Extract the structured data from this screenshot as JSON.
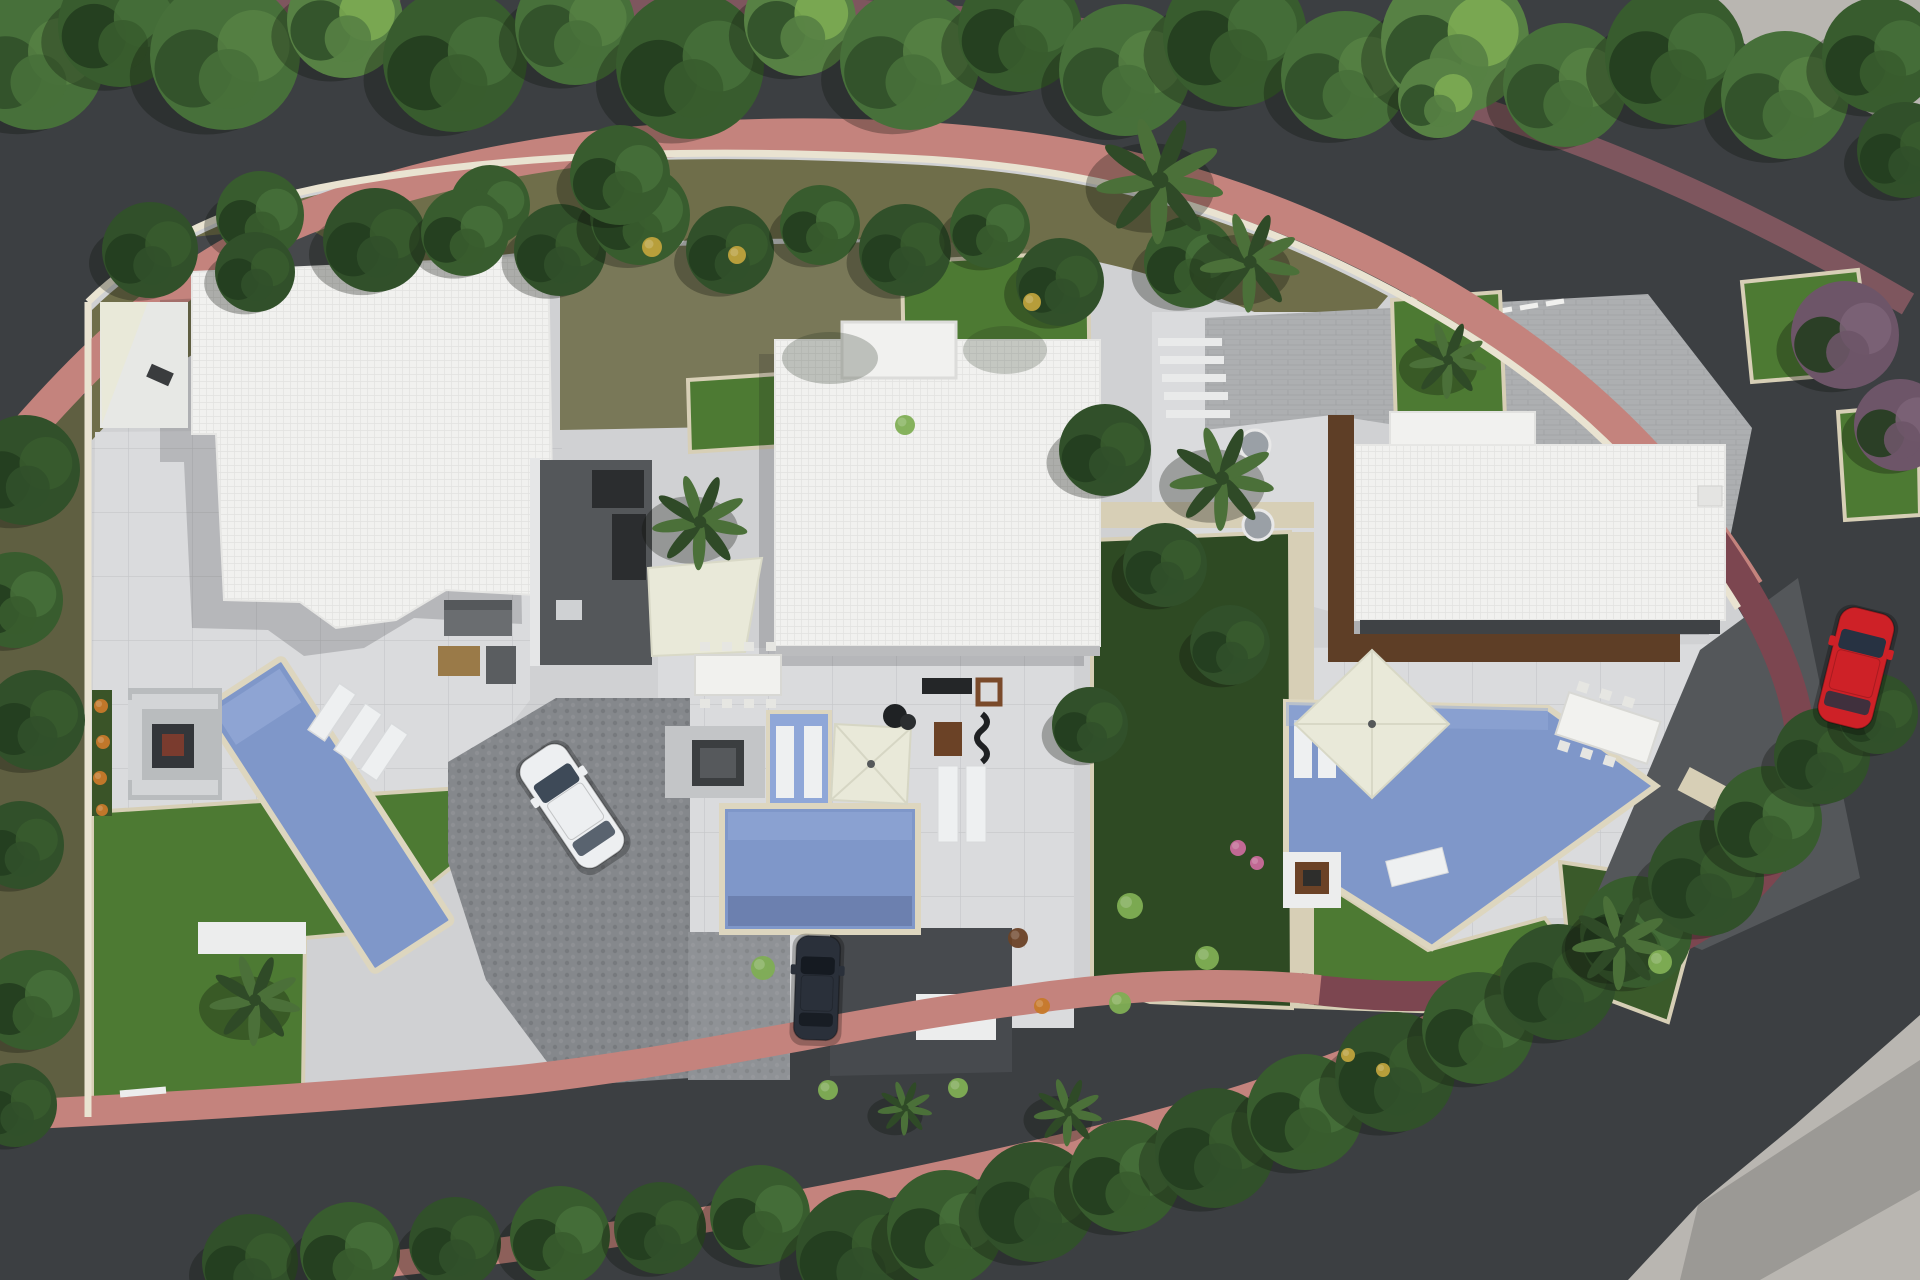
{
  "meta": {
    "description": "Aerial 3D architectural site plan render: three modern flat-roof villas with pools and gardens along a curving tree-lined road",
    "canvas": {
      "width": 1920,
      "height": 1280
    },
    "villa_count": 3,
    "pool_count": 4,
    "car_count": 3
  },
  "palette": {
    "road": "#3c3f42",
    "sidewalkPink": "#c4837d",
    "sidewalkMauve": "#7e565e",
    "sidewalkMaroon": "#7c4650",
    "wall": "#e9e3d1",
    "stone": "#d7cfb6",
    "concrete": "#b9b6b1",
    "olive": "#6f6e4a",
    "oliveDark": "#5f5f41",
    "lawn": "#4d7a33",
    "bedDark": "#2e4a23",
    "bedMid": "#3a5a2a",
    "treeA": "#47703a",
    "treeB": "#385c2e",
    "treeC": "#578144",
    "treeDark": "#31502a",
    "treeDeep": "#243d1f",
    "treePurple": "#6d5568",
    "treePurpleLight": "#7d6478",
    "palm": "#4b7039",
    "palmDark": "#2f4a27",
    "terrace": "#d0d1d3",
    "terraceLight": "#dadbdd",
    "path": "#eceded",
    "roof": "#f1f1ef",
    "roofLine": "#e2e2e0",
    "roofShade": "#bbbcbe",
    "court": "#54575a",
    "courtDark": "#2b2d2f",
    "cobble": "#85888c",
    "cobbleLight": "#8f9296",
    "paver": "#adafb1",
    "patioDark": "#474a4e",
    "pool": "#7f97c9",
    "poolLight": "#94aad7",
    "spa": "#8fa7d8",
    "rim": "#ddd6bf",
    "cream": "#e9e9d9",
    "wood": "#9a7a48",
    "deck": "#5e3e26",
    "rust": "#6b4226",
    "white": "#eef0f1",
    "shadow": "rgba(12,16,10,0.30)",
    "roofShadow": "rgba(20,24,26,0.18)",
    "carWhiteBody": "#edeff1",
    "carDarkBody": "#2a303a",
    "carRedBody": "#ce2127",
    "accentYellow": "#bfa23c",
    "accentOrange": "#c7792a",
    "accentPink": "#c96a9b",
    "fern": "#7fae54"
  },
  "scene": {
    "trees": {
      "top": [
        [
          35,
          60,
          70,
          "a"
        ],
        [
          120,
          25,
          62,
          "b"
        ],
        [
          225,
          55,
          75,
          "a"
        ],
        [
          345,
          20,
          58,
          "c"
        ],
        [
          455,
          60,
          72,
          "b"
        ],
        [
          575,
          25,
          60,
          "a"
        ],
        [
          690,
          65,
          74,
          "b"
        ],
        [
          800,
          20,
          56,
          "c"
        ],
        [
          910,
          60,
          70,
          "a"
        ],
        [
          1020,
          30,
          62,
          "b"
        ],
        [
          1125,
          70,
          66,
          "a"
        ],
        [
          1235,
          35,
          72,
          "b"
        ],
        [
          1345,
          75,
          64,
          "a"
        ],
        [
          1455,
          40,
          74,
          "c"
        ],
        [
          1565,
          85,
          62,
          "a"
        ],
        [
          1675,
          55,
          70,
          "b"
        ],
        [
          1785,
          95,
          64,
          "a"
        ],
        [
          1880,
          55,
          58,
          "b"
        ],
        [
          1905,
          150,
          48,
          "d"
        ]
      ],
      "olive": [
        [
          150,
          250,
          48,
          "d"
        ],
        [
          260,
          215,
          44,
          "b"
        ],
        [
          375,
          240,
          52,
          "d"
        ],
        [
          490,
          205,
          40,
          "b"
        ],
        [
          560,
          250,
          46,
          "d"
        ],
        [
          640,
          215,
          50,
          "b"
        ],
        [
          730,
          250,
          44,
          "d"
        ],
        [
          820,
          225,
          40,
          "b"
        ],
        [
          905,
          250,
          46,
          "d"
        ],
        [
          990,
          228,
          40,
          "b"
        ],
        [
          1060,
          282,
          44,
          "d"
        ],
        [
          1190,
          262,
          46,
          "b"
        ],
        [
          255,
          272,
          40,
          "d"
        ],
        [
          465,
          232,
          44,
          "b"
        ]
      ],
      "left": [
        [
          25,
          470,
          55,
          "d"
        ],
        [
          15,
          600,
          48,
          "b"
        ],
        [
          35,
          720,
          50,
          "d"
        ],
        [
          20,
          845,
          44,
          "d"
        ],
        [
          30,
          1000,
          50,
          "b"
        ],
        [
          15,
          1105,
          42,
          "d"
        ]
      ],
      "hedge": [
        [
          250,
          1262,
          48,
          "d"
        ],
        [
          350,
          1252,
          50,
          "b"
        ],
        [
          455,
          1243,
          46,
          "d"
        ],
        [
          560,
          1236,
          50,
          "b"
        ],
        [
          660,
          1228,
          46,
          "d"
        ],
        [
          760,
          1215,
          50,
          "b"
        ],
        [
          858,
          1252,
          62,
          "d"
        ],
        [
          945,
          1228,
          58,
          "b"
        ],
        [
          1035,
          1202,
          60,
          "d"
        ],
        [
          1125,
          1176,
          56,
          "b"
        ],
        [
          1215,
          1148,
          60,
          "d"
        ],
        [
          1305,
          1112,
          58,
          "b"
        ],
        [
          1395,
          1072,
          60,
          "d"
        ],
        [
          1478,
          1028,
          56,
          "b"
        ],
        [
          1558,
          982,
          58,
          "d"
        ],
        [
          1636,
          932,
          56,
          "b"
        ],
        [
          1706,
          878,
          58,
          "d"
        ],
        [
          1768,
          820,
          54,
          "b"
        ],
        [
          1822,
          756,
          48,
          "d"
        ],
        [
          1878,
          714,
          40,
          "d"
        ]
      ],
      "garden": [
        [
          1105,
          450,
          46,
          "d"
        ],
        [
          1165,
          565,
          42,
          "d"
        ],
        [
          1230,
          645,
          40,
          "d"
        ],
        [
          1090,
          725,
          38,
          "d"
        ],
        [
          1845,
          335,
          54,
          "p"
        ],
        [
          1900,
          425,
          46,
          "p"
        ],
        [
          620,
          175,
          50,
          "b"
        ],
        [
          1438,
          98,
          40,
          "c"
        ]
      ]
    },
    "palms": [
      [
        255,
        1000,
        1.0
      ],
      [
        700,
        522,
        1.05
      ],
      [
        1160,
        180,
        1.4
      ],
      [
        1250,
        262,
        1.1
      ],
      [
        1222,
        478,
        1.15
      ],
      [
        1448,
        360,
        0.85
      ],
      [
        1620,
        942,
        1.05
      ],
      [
        1068,
        1112,
        0.75
      ],
      [
        905,
        1108,
        0.6
      ]
    ],
    "shrubs": [
      [
        101,
        706,
        7,
        "accentOrange"
      ],
      [
        103,
        742,
        7,
        "accentOrange"
      ],
      [
        100,
        778,
        7,
        "accentOrange"
      ],
      [
        102,
        810,
        6,
        "accentOrange"
      ],
      [
        652,
        247,
        10,
        "accentYellow"
      ],
      [
        737,
        255,
        9,
        "accentYellow"
      ],
      [
        1032,
        302,
        9,
        "accentYellow"
      ],
      [
        1348,
        1055,
        7,
        "accentYellow"
      ],
      [
        1383,
        1070,
        7,
        "accentYellow"
      ],
      [
        1238,
        848,
        8,
        "accentPink"
      ],
      [
        1257,
        863,
        7,
        "accentPink"
      ],
      [
        763,
        968,
        12,
        "fern"
      ],
      [
        1130,
        906,
        13,
        "fern"
      ],
      [
        1207,
        958,
        12,
        "fern"
      ],
      [
        1120,
        1003,
        11,
        "fern"
      ],
      [
        905,
        425,
        10,
        "fern"
      ],
      [
        1660,
        962,
        12,
        "fern"
      ],
      [
        828,
        1090,
        10,
        "fern"
      ],
      [
        958,
        1088,
        10,
        "fern"
      ],
      [
        1018,
        938,
        10,
        "rust"
      ],
      [
        1042,
        1006,
        8,
        "accentOrange"
      ]
    ],
    "cars": [
      {
        "id": "car-white",
        "x": 572,
        "y": 806,
        "angle": -34,
        "len": 128,
        "wid": 54,
        "body": "carWhiteBody",
        "glass": "#3e4a58"
      },
      {
        "id": "car-dark",
        "x": 817,
        "y": 988,
        "angle": 2,
        "len": 104,
        "wid": 44,
        "body": "carDarkBody",
        "glass": "#151a21"
      },
      {
        "id": "car-red",
        "x": 1856,
        "y": 668,
        "angle": 14,
        "len": 118,
        "wid": 56,
        "body": "carRedBody",
        "glass": "#273242"
      }
    ]
  }
}
